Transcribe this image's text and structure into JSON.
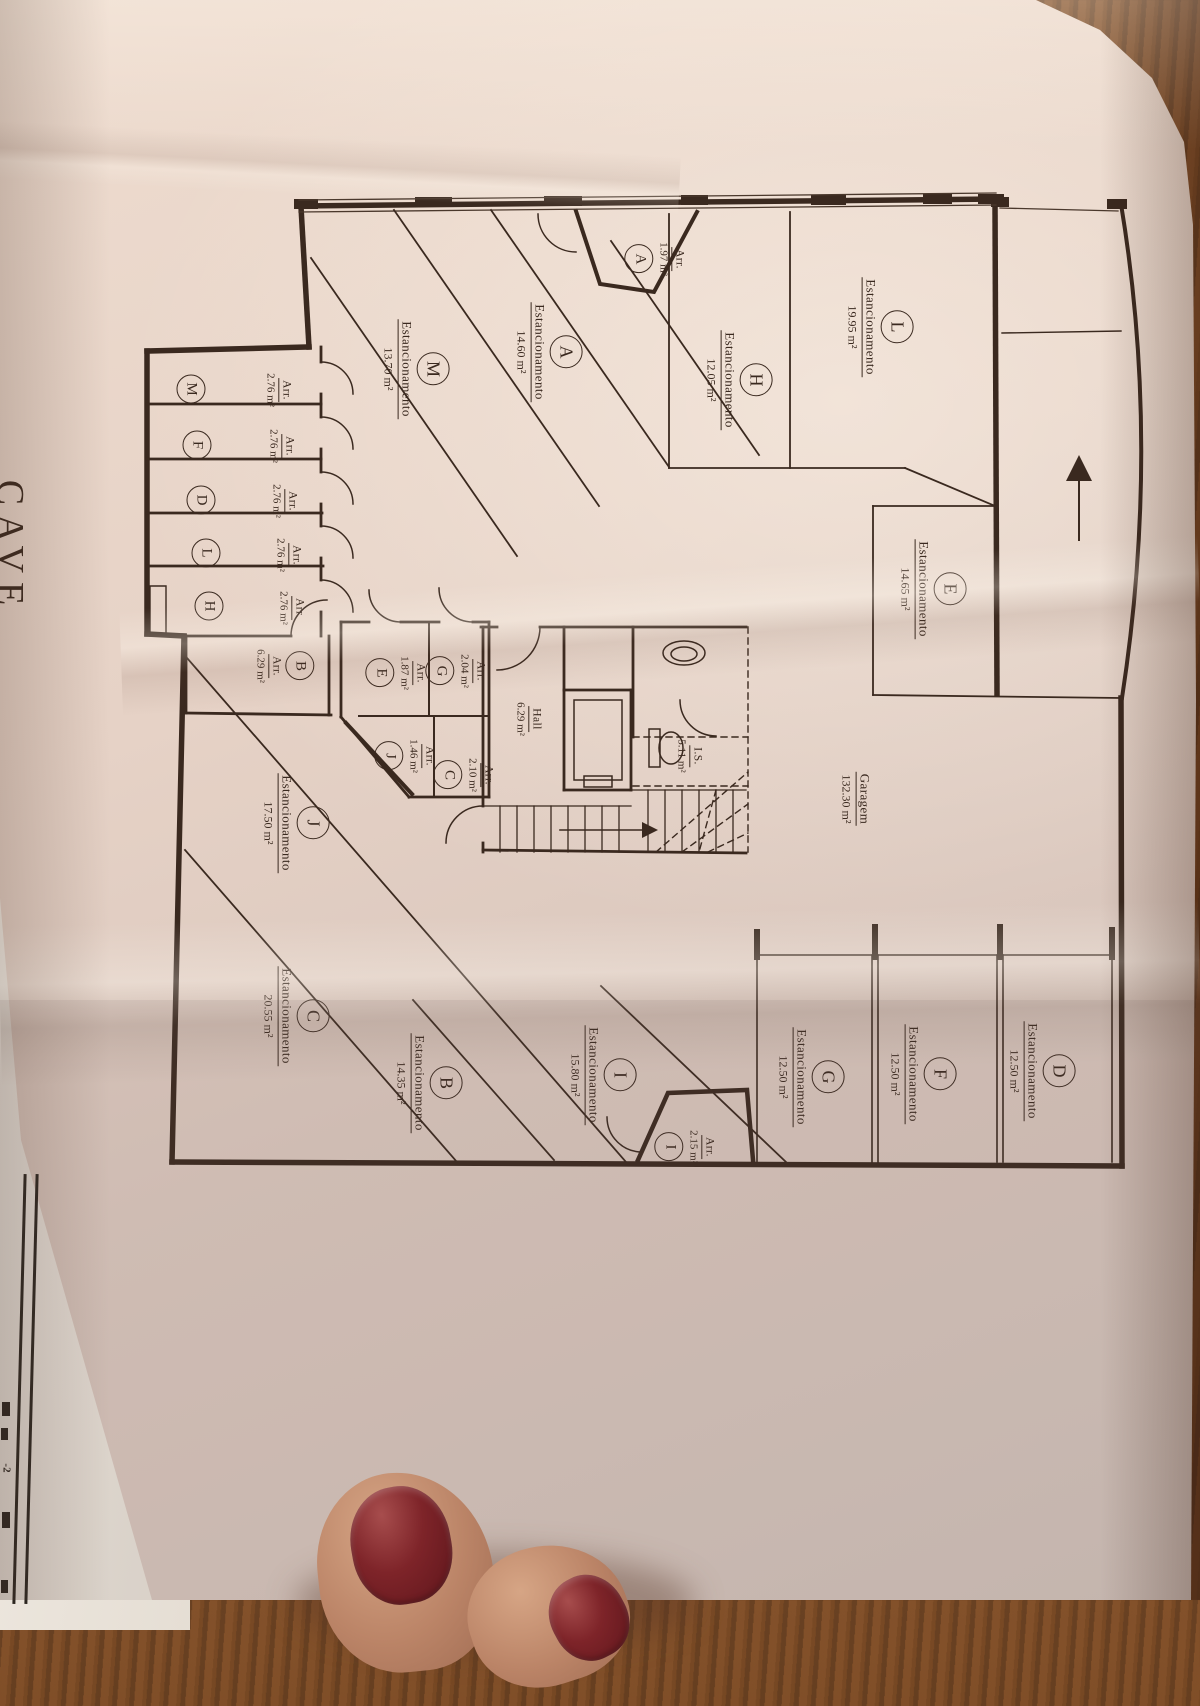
{
  "sheet": {
    "title": "CAVE",
    "corner_mark": "-2"
  },
  "labels": {
    "parking": "Estancionamento",
    "storage": "Arr."
  },
  "rooms": {
    "garage": {
      "name": "Garagem",
      "area": "132.30 m²"
    },
    "hall": {
      "name": "Hall",
      "area": "6.29 m²"
    },
    "wc": {
      "name": "I.S.",
      "area": "5.11 m²"
    },
    "parking": [
      {
        "id": "L",
        "area": "19.95 m²"
      },
      {
        "id": "H",
        "area": "12.05 m²"
      },
      {
        "id": "A",
        "area": "14.60 m²"
      },
      {
        "id": "M",
        "area": "13.70 m²"
      },
      {
        "id": "E",
        "area": "14.65 m²"
      },
      {
        "id": "J",
        "area": "17.50 m²"
      },
      {
        "id": "C",
        "area": "20.55 m²"
      },
      {
        "id": "B",
        "area": "14.35 m²"
      },
      {
        "id": "I",
        "area": "15.80 m²"
      },
      {
        "id": "G",
        "area": "12.50 m²"
      },
      {
        "id": "F",
        "area": "12.50 m²"
      },
      {
        "id": "D",
        "area": "12.50 m²"
      }
    ],
    "storage": [
      {
        "id": "A",
        "area": "1.97 m²"
      },
      {
        "id": "M",
        "area": "2.76 m²"
      },
      {
        "id": "F",
        "area": "2.76 m²"
      },
      {
        "id": "D",
        "area": "2.76 m²"
      },
      {
        "id": "L",
        "area": "2.76 m²"
      },
      {
        "id": "H",
        "area": "2.76 m²"
      },
      {
        "id": "B",
        "area": "6.29 m²"
      },
      {
        "id": "E",
        "area": "1.87 m²"
      },
      {
        "id": "G",
        "area": "2.04 m²"
      },
      {
        "id": "J",
        "area": "1.46 m²"
      },
      {
        "id": "C",
        "area": "2.10 m²"
      },
      {
        "id": "I",
        "area": "2.15 m²"
      }
    ]
  },
  "colors": {
    "paper": "#e7d4c8",
    "ink": "#3a291f",
    "wood": "#7a4a24",
    "nail": "#6e1c22",
    "skin": "#b9826a",
    "under_sheet": "#f0eae2"
  }
}
